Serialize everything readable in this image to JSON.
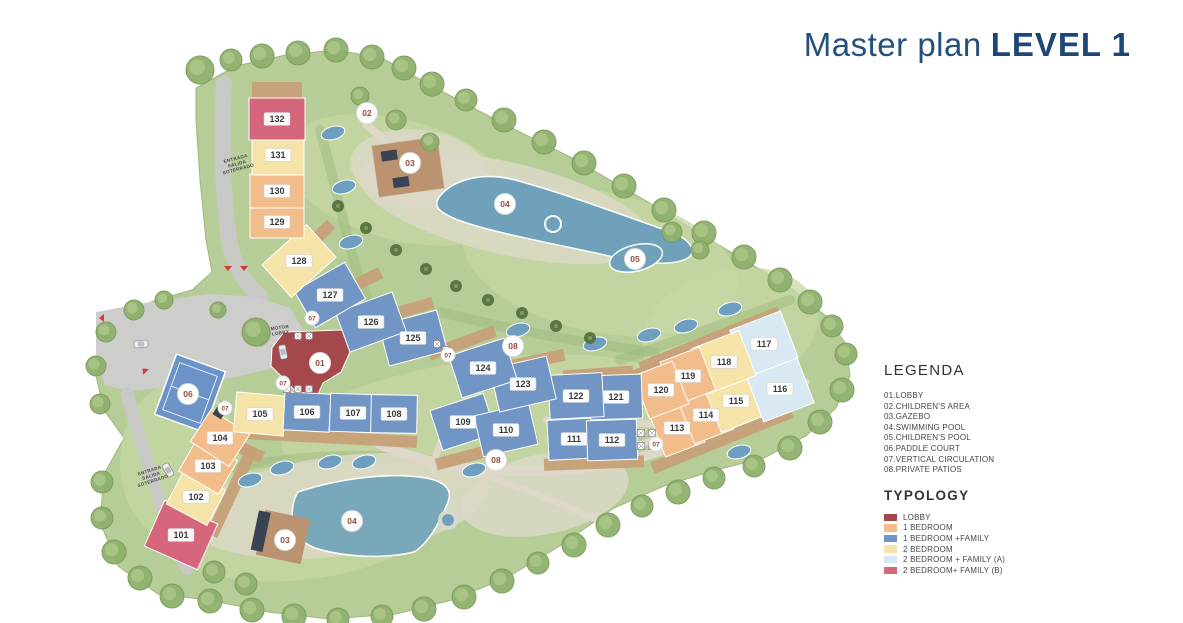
{
  "title": {
    "prefix": "Master plan",
    "emphasis": "LEVEL 1"
  },
  "legend": {
    "heading": "LEGENDA",
    "items": [
      "01.LOBBY",
      "02.CHILDREN'S AREA",
      "03.GAZEBO",
      "04.SWIMMING POOL",
      "05.CHILDREN'S POOL",
      "06.PADDLE COURT",
      "07.VERTICAL CIRCULATION",
      "08.PRIVATE PATIOS"
    ]
  },
  "typology": {
    "heading": "TYPOLOGY",
    "items": [
      {
        "key": "lobby",
        "label": "LOBBY",
        "color": "#a5484b"
      },
      {
        "key": "1b",
        "label": "1 BEDROOM",
        "color": "#f2bd8b"
      },
      {
        "key": "1bf",
        "label": "1 BEDROOM +FAMILY",
        "color": "#7195c5"
      },
      {
        "key": "2b",
        "label": "2 BEDROOM",
        "color": "#f5e3a8"
      },
      {
        "key": "2bf_a",
        "label": "2 BEDROOM + FAMILY (A)",
        "color": "#d8e9f3"
      },
      {
        "key": "2bf_b",
        "label": "2 BEDROOM+ FAMILY (B)",
        "color": "#d5667b"
      }
    ]
  },
  "plan": {
    "marker_text_color": "#9a4a3c",
    "units": [
      [
        "101",
        "2bf_b",
        181,
        535,
        58,
        50,
        24
      ],
      [
        "102",
        "2b",
        196,
        497,
        46,
        40,
        28
      ],
      [
        "103",
        "1b",
        208,
        466,
        46,
        38,
        30
      ],
      [
        "104",
        "1b",
        220,
        438,
        46,
        38,
        33
      ],
      [
        "105",
        "2b",
        260,
        414,
        50,
        40,
        5
      ],
      [
        "106",
        "1bf",
        307,
        412,
        46,
        38,
        3
      ],
      [
        "107",
        "1bf",
        353,
        413,
        46,
        38,
        2
      ],
      [
        "108",
        "1bf",
        394,
        414,
        46,
        38,
        1
      ],
      [
        "109",
        "1bf",
        463,
        422,
        56,
        42,
        -18
      ],
      [
        "110",
        "1bf",
        506,
        430,
        56,
        42,
        -13
      ],
      [
        "111",
        "1bf",
        574,
        439,
        52,
        40,
        -3
      ],
      [
        "112",
        "1bf",
        612,
        440,
        50,
        40,
        -2
      ],
      [
        "113",
        "1b",
        677,
        428,
        42,
        46,
        -21
      ],
      [
        "114",
        "1b",
        706,
        415,
        42,
        46,
        -21
      ],
      [
        "115",
        "2b",
        736,
        401,
        50,
        48,
        -21
      ],
      [
        "116",
        "2bf_a",
        780,
        389,
        54,
        50,
        -21
      ],
      [
        "117",
        "2bf_a",
        764,
        344,
        54,
        50,
        -21
      ],
      [
        "118",
        "2b",
        724,
        362,
        50,
        48,
        -21
      ],
      [
        "119",
        "1b",
        688,
        376,
        42,
        46,
        -21
      ],
      [
        "120",
        "1b",
        661,
        390,
        42,
        46,
        -21
      ],
      [
        "121",
        "1bf",
        616,
        397,
        52,
        44,
        -2
      ],
      [
        "122",
        "1bf",
        576,
        396,
        54,
        44,
        -3
      ],
      [
        "123",
        "1bf",
        523,
        384,
        58,
        44,
        -13
      ],
      [
        "124",
        "1bf",
        483,
        368,
        58,
        44,
        -18
      ],
      [
        "125",
        "1bf",
        413,
        338,
        60,
        42,
        -15
      ],
      [
        "126",
        "1bf",
        371,
        322,
        60,
        42,
        -20
      ],
      [
        "127",
        "1bf",
        330,
        295,
        58,
        42,
        -30
      ],
      [
        "128",
        "2b",
        299,
        261,
        60,
        44,
        -42
      ],
      [
        "129",
        "1b",
        277,
        222,
        54,
        32,
        0
      ],
      [
        "130",
        "1b",
        277,
        191,
        54,
        34,
        0
      ],
      [
        "131",
        "2b",
        278,
        155,
        52,
        40,
        0
      ],
      [
        "132",
        "2bf_b",
        277,
        119,
        56,
        42,
        0
      ]
    ],
    "lobby_unit": {
      "type": "lobby",
      "points": "284,332 342,330 350,352 341,372 323,383 318,394 297,393 284,379 271,366 272,348"
    },
    "markers": [
      {
        "n": "01",
        "x": 320,
        "y": 363
      },
      {
        "n": "02",
        "x": 367,
        "y": 113
      },
      {
        "n": "03",
        "x": 410,
        "y": 163
      },
      {
        "n": "03",
        "x": 285,
        "y": 540
      },
      {
        "n": "04",
        "x": 505,
        "y": 204
      },
      {
        "n": "04",
        "x": 352,
        "y": 521
      },
      {
        "n": "05",
        "x": 635,
        "y": 259
      },
      {
        "n": "06",
        "x": 188,
        "y": 394
      },
      {
        "n": "07",
        "x": 312,
        "y": 318
      },
      {
        "n": "07",
        "x": 283,
        "y": 383
      },
      {
        "n": "07",
        "x": 225,
        "y": 408
      },
      {
        "n": "07",
        "x": 448,
        "y": 355
      },
      {
        "n": "07",
        "x": 656,
        "y": 444
      },
      {
        "n": "08",
        "x": 513,
        "y": 346
      },
      {
        "n": "08",
        "x": 496,
        "y": 460
      }
    ],
    "annotations": [
      {
        "id": "entrance-top",
        "lines": [
          "ENTRADA",
          "SALIDA",
          "SOTERRADO"
        ],
        "x": 236,
        "y": 160,
        "rot": -15
      },
      {
        "id": "entrance-bottom",
        "lines": [
          "ENTRADA",
          "SALIDA",
          "SOTERRADO"
        ],
        "x": 150,
        "y": 472,
        "rot": -18
      },
      {
        "id": "motor-lobby",
        "lines": [
          "MOTOR",
          "LOBBY"
        ],
        "x": 280,
        "y": 329,
        "rot": -8
      }
    ]
  }
}
